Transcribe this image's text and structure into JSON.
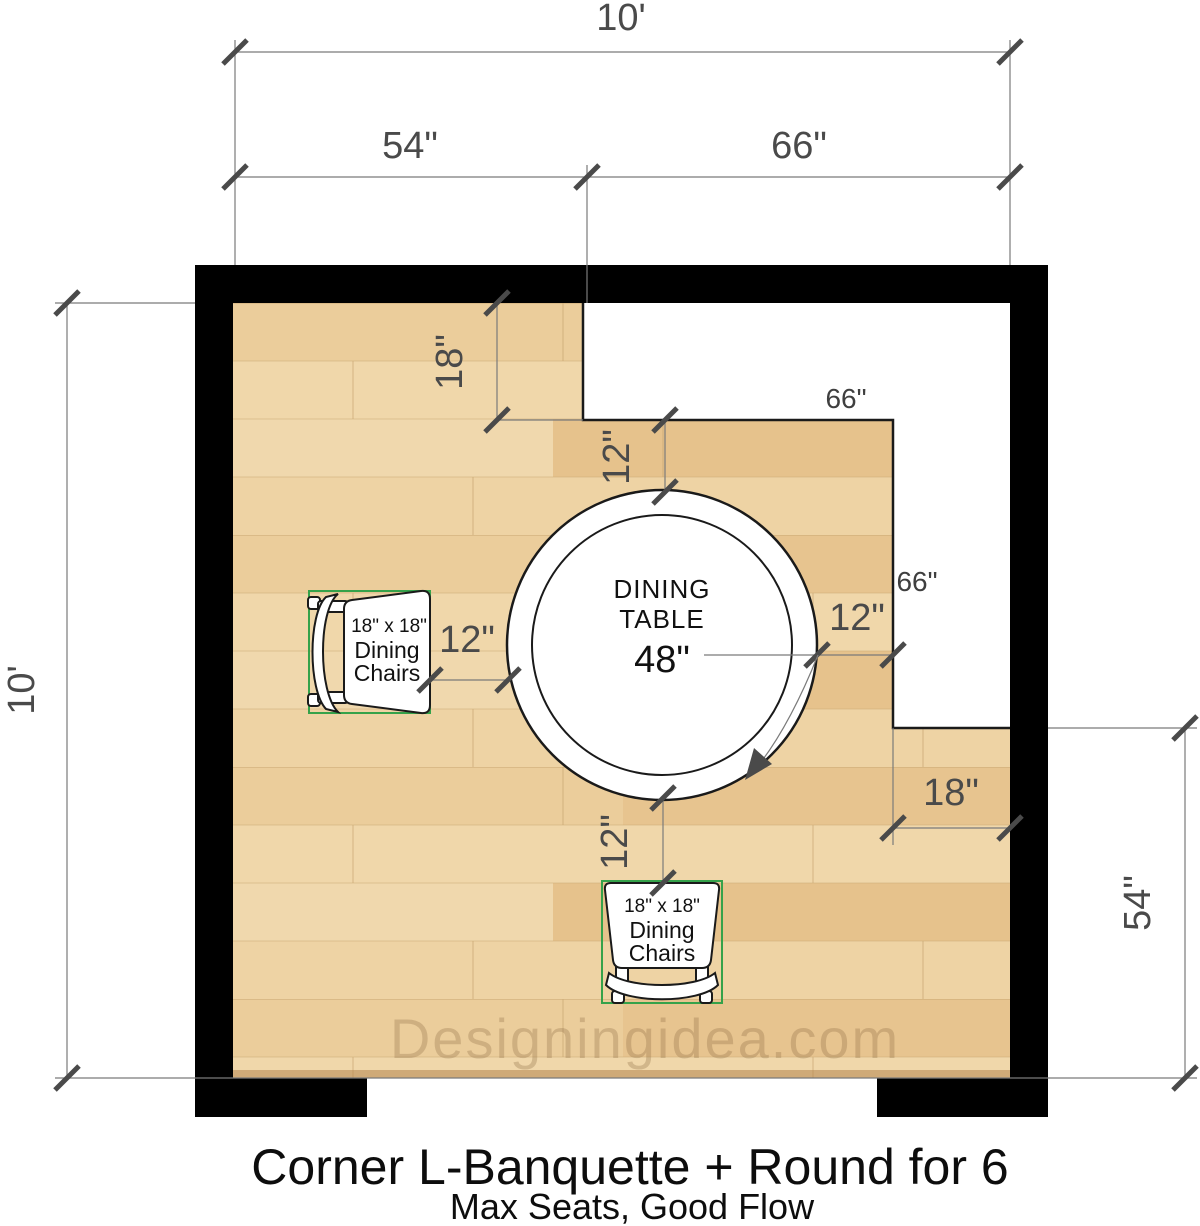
{
  "title": "Corner L-Banquette + Round for 6",
  "subtitle": "Max Seats, Good Flow",
  "watermark": "Designingidea.com",
  "table": {
    "line1": "DINING",
    "line2": "TABLE",
    "diameter": "48\""
  },
  "chair_left": {
    "size": "18\" x 18\"",
    "line1": "Dining",
    "line2": "Chairs"
  },
  "chair_bottom": {
    "size": "18\" x 18\"",
    "line1": "Dining",
    "line2": "Chairs"
  },
  "dims": {
    "room_width_ft": "10'",
    "room_height_ft": "10'",
    "left_span": "54\"",
    "right_span": "66\"",
    "bench_top_depth": "18\"",
    "clearance_top": "12\"",
    "clearance_left": "12\"",
    "clearance_right": "12\"",
    "clearance_bottom": "12\"",
    "bench_right_depth": "18\"",
    "right_wall_span": "54\"",
    "bench_top_length": "66\"",
    "bench_right_length": "66\""
  },
  "colors": {
    "wall": "#000000",
    "bench": "#ffffff",
    "dimension_text": "#4a4a4a",
    "chair_bounding_box": "#35a24a",
    "floor_base": "#ebcd9b"
  }
}
